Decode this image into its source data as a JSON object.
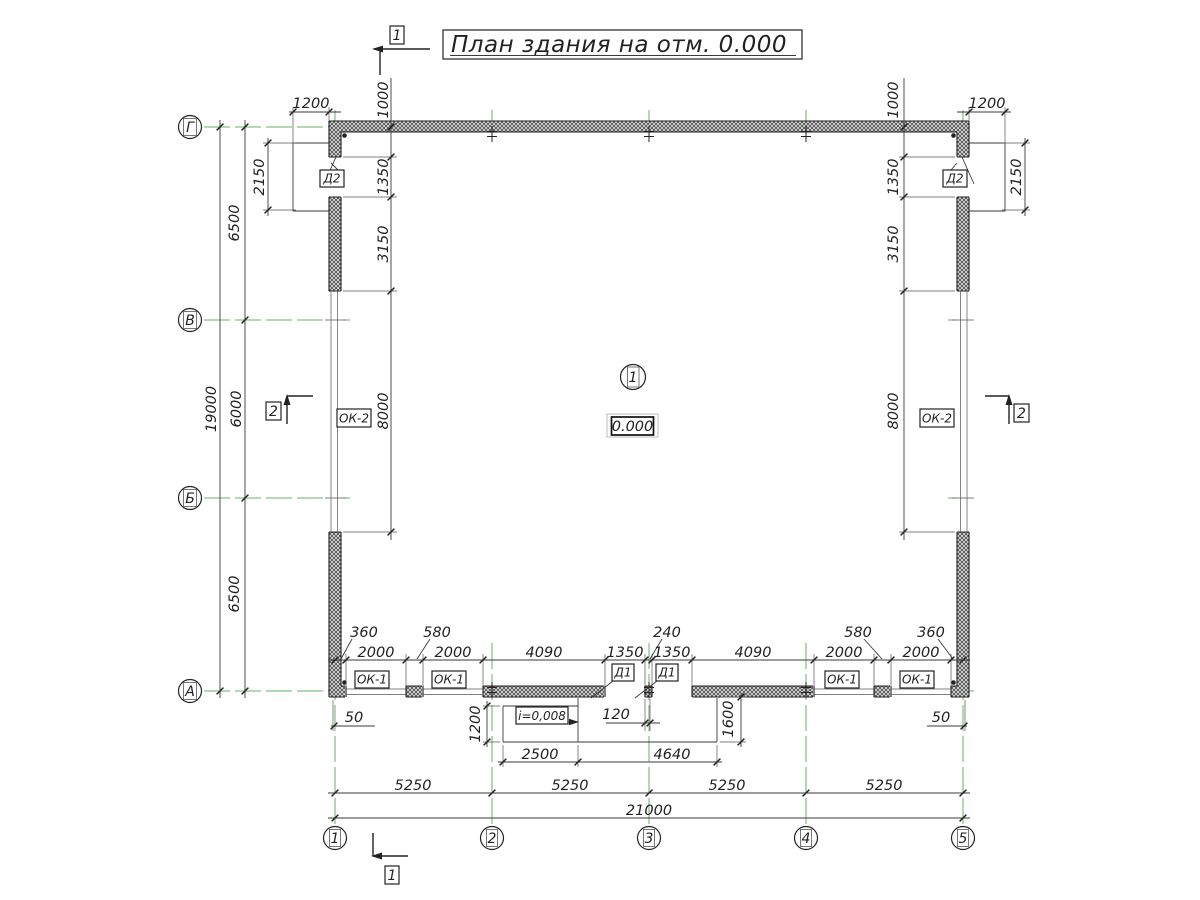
{
  "title": "План здания на отм. 0.000",
  "axes": {
    "rows": [
      "Г",
      "В",
      "Б",
      "А"
    ],
    "cols": [
      "1",
      "2",
      "3",
      "4",
      "5"
    ]
  },
  "room": {
    "number": "1",
    "elevation": "0.000"
  },
  "sections": {
    "one": "1",
    "two": "2"
  },
  "tags": {
    "door2": "Д2",
    "window2": "ОК-2",
    "window1": "ОК-1",
    "door1": "Д1",
    "slope": "i=0,008"
  },
  "dims": {
    "porch_width": "1200",
    "door_offset": "1000",
    "porch_height": "2150",
    "span_top": "6500",
    "span_mid": "6000",
    "span_bottom": "6500",
    "height_total": "19000",
    "chain_door": "1350",
    "chain_wall": "3150",
    "chain_window": "8000",
    "callout_360": "360",
    "callout_580": "580",
    "callout_240": "240",
    "win_2000": "2000",
    "pier_4090": "4090",
    "door_1350": "1350",
    "axis_off_50": "50",
    "pier_off_120": "120",
    "ramp_width": "1200",
    "ramp_len": "2500",
    "platform_len": "4640",
    "platform_width": "1600",
    "bay": "5250",
    "width_total": "21000"
  },
  "colors": {
    "axis_green": "#66b366",
    "line": "#3a3a3a"
  }
}
